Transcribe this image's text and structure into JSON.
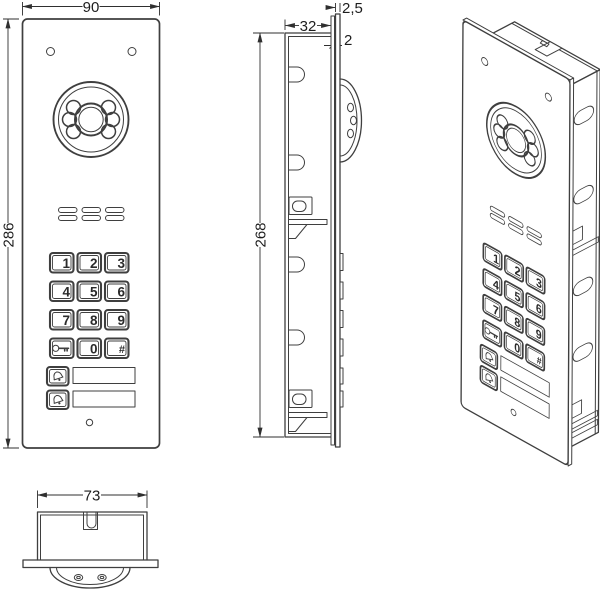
{
  "drawing": {
    "dimensions": {
      "front_width": "90",
      "front_height": "286",
      "box_depth": "32",
      "panel_thickness": "2,5",
      "frame_thickness": "2",
      "box_height": "268",
      "bottom_width": "73"
    },
    "keypad": {
      "digits": [
        "1",
        "2",
        "3",
        "4",
        "5",
        "6",
        "7",
        "8",
        "9"
      ],
      "zero": "0",
      "hash": "#"
    },
    "colors": {
      "line": "#3f3f3f",
      "dimension": "#2f2f2f",
      "background": "#ffffff"
    }
  }
}
